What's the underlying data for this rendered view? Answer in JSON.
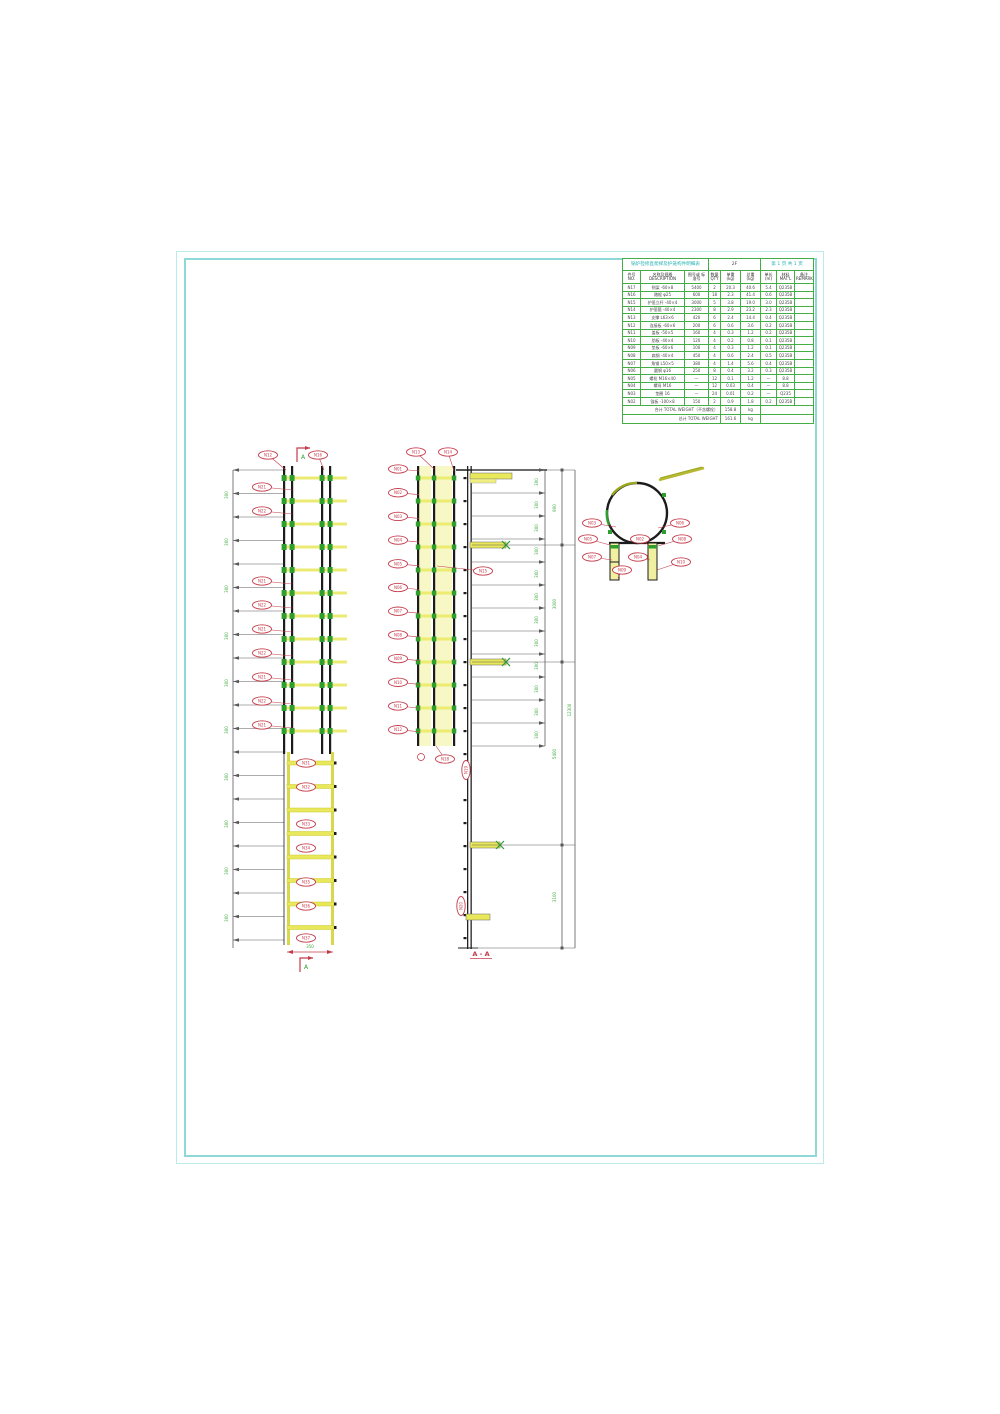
{
  "table": {
    "title_left": "锅炉检修直爬梯及护笼构件明细表",
    "title_mid": "2F",
    "title_right": "第 1 页  共 1 页",
    "headers": [
      "件号 NO.",
      "名称及规格 DESCRIPTION",
      "图号或 标准号",
      "数量 QTY",
      "单重 (kg)",
      "总重 (kg)",
      "单长 (m)",
      "材料 MAT'L",
      "备注 REMARK"
    ],
    "rows": [
      [
        "N17",
        "侧梁 -60×8",
        "5400",
        "2",
        "20.3",
        "40.6",
        "5.4",
        "Q235B",
        ""
      ],
      [
        "N16",
        "踏棍 φ25",
        "600",
        "18",
        "2.3",
        "41.4",
        "0.6",
        "Q235B",
        ""
      ],
      [
        "N15",
        "护笼立杆 -40×4",
        "3000",
        "5",
        "3.8",
        "19.0",
        "3.0",
        "Q235B",
        ""
      ],
      [
        "N14",
        "护笼箍 -40×4",
        "2300",
        "8",
        "2.9",
        "23.2",
        "2.3",
        "Q235B",
        ""
      ],
      [
        "N13",
        "支撑 L63×6",
        "420",
        "6",
        "2.4",
        "14.4",
        "0.4",
        "Q235B",
        ""
      ],
      [
        "N12",
        "连接板 -60×6",
        "200",
        "6",
        "0.6",
        "3.6",
        "0.2",
        "Q235B",
        ""
      ],
      [
        "N11",
        "盖板 -50×5",
        "160",
        "4",
        "0.3",
        "1.2",
        "0.2",
        "Q235B",
        ""
      ],
      [
        "N10",
        "肋板 -40×4",
        "120",
        "4",
        "0.2",
        "0.8",
        "0.1",
        "Q235B",
        ""
      ],
      [
        "N09",
        "垫板 -60×6",
        "100",
        "4",
        "0.3",
        "1.2",
        "0.1",
        "Q235B",
        ""
      ],
      [
        "N08",
        "扁钢 -40×4",
        "450",
        "4",
        "0.6",
        "2.4",
        "0.5",
        "Q235B",
        ""
      ],
      [
        "N07",
        "角钢 L50×5",
        "380",
        "4",
        "1.4",
        "5.6",
        "0.4",
        "Q235B",
        ""
      ],
      [
        "N06",
        "圆钢 φ16",
        "250",
        "8",
        "0.4",
        "3.2",
        "0.3",
        "Q235B",
        ""
      ],
      [
        "N05",
        "螺栓 M16×40",
        "—",
        "12",
        "0.1",
        "1.2",
        "—",
        "8.8",
        ""
      ],
      [
        "N04",
        "螺母 M16",
        "—",
        "12",
        "0.03",
        "0.4",
        "—",
        "8.8",
        ""
      ],
      [
        "N03",
        "垫圈 16",
        "—",
        "24",
        "0.01",
        "0.2",
        "—",
        "Q235",
        ""
      ],
      [
        "N02",
        "锚板 -100×8",
        "150",
        "2",
        "0.9",
        "1.8",
        "0.2",
        "Q235B",
        ""
      ]
    ],
    "footers": [
      {
        "label": "合计 TOTAL WEIGHT（不含螺栓）",
        "value": "158.8",
        "unit": "kg"
      },
      {
        "label": "总计 TOTAL WEIGHT",
        "value": "161.6",
        "unit": "kg"
      }
    ]
  },
  "views": {
    "left": {
      "top_balloons": [
        "N12",
        "N16"
      ],
      "side_balloons": [
        "N21",
        "N22",
        "N21",
        "N22",
        "N21",
        "N22",
        "N21",
        "N22",
        "N21"
      ],
      "center_balloons": [
        "N31",
        "N32",
        "N33",
        "N34",
        "N35",
        "N36",
        "N37"
      ],
      "dims": [
        "300",
        "300",
        "300",
        "300",
        "300",
        "300",
        "300",
        "300",
        "300",
        "300"
      ],
      "bottom_dim": "350",
      "section_letter": "A"
    },
    "middle": {
      "top_balloons": [
        "N13",
        "N14"
      ],
      "side_balloons": [
        "N01",
        "N02",
        "N03",
        "N04",
        "N05",
        "N06",
        "N07",
        "N08",
        "N09",
        "N10",
        "N11",
        "N12"
      ],
      "leader_balloon": "N15",
      "wall_balloons": [
        "N19",
        "N18",
        "N20"
      ],
      "rung_dims": [
        "300",
        "300",
        "300",
        "300",
        "300",
        "300",
        "300",
        "300",
        "300",
        "300",
        "300",
        "300"
      ],
      "span_dims": [
        "900",
        "3000",
        "5400",
        "3100"
      ],
      "overall_dim": "12300",
      "caption": "A - A"
    },
    "detail": {
      "balloons": [
        "N03",
        "N05",
        "N07",
        "N09",
        "N02",
        "N04",
        "N06",
        "N08",
        "N10"
      ]
    }
  }
}
